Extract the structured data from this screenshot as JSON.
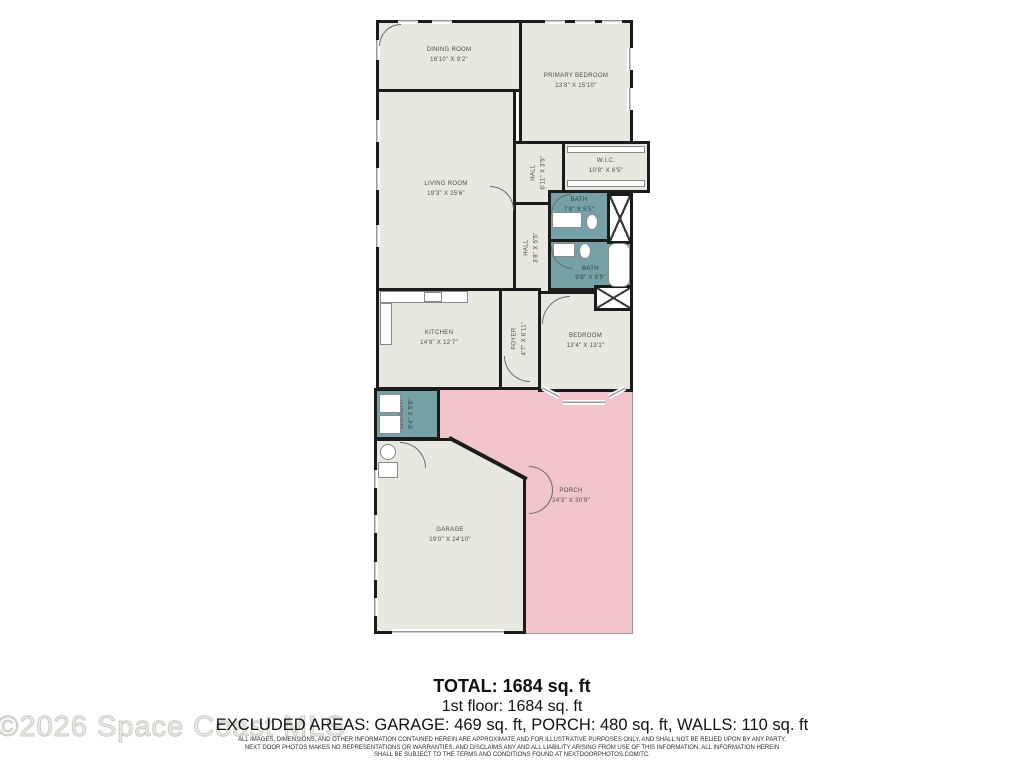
{
  "plan": {
    "rooms": {
      "dining": {
        "name": "DINING ROOM",
        "dims": "16'10\" X 9'2\""
      },
      "primary": {
        "name": "PRIMARY BEDROOM",
        "dims": "13'8\" X 15'10\""
      },
      "living": {
        "name": "LIVING ROOM",
        "dims": "19'3\" X 25'6\""
      },
      "wic": {
        "name": "W.I.C.",
        "dims": "10'8\" X 6'5\""
      },
      "hall1": {
        "name": "HALL",
        "dims": "6'11\" X 3'5\""
      },
      "hall2": {
        "name": "HALL",
        "dims": "3'8\" X 5'5\""
      },
      "bath1": {
        "name": "BATH",
        "dims": "7'8\" X 5'5\""
      },
      "bath2": {
        "name": "BATH",
        "dims": "9'8\" X 8'5\""
      },
      "kitchen": {
        "name": "KITCHEN",
        "dims": "14'9\" X 12'7\""
      },
      "foyer": {
        "name": "FOYER",
        "dims": "4'7\" X 6'11\""
      },
      "bedroom": {
        "name": "BEDROOM",
        "dims": "13'4\" X 13'1\""
      },
      "laundry": {
        "name": "LAUNDRY",
        "dims": "8'4\" X 5'5\""
      },
      "garage": {
        "name": "GARAGE",
        "dims": "19'0\" X 24'10\""
      },
      "porch": {
        "name": "PORCH",
        "dims": "24'3\" X 30'9\""
      }
    },
    "colors": {
      "wall": "#1b1b1b",
      "floor": "#e9e8e0",
      "wet_area": "#76a1a7",
      "excluded_area": "#f1c5c9"
    }
  },
  "summary": {
    "total": "TOTAL: 1684 sq. ft",
    "floor1": "1st floor: 1684 sq. ft",
    "excluded": "EXCLUDED AREAS: GARAGE: 469 sq. ft, PORCH: 480 sq. ft, WALLS: 110 sq. ft"
  },
  "disclaimer": {
    "line1": "ALL IMAGES, DIMENSIONS, AND OTHER INFORMATION CONTAINED HEREIN ARE APPROXIMATE AND FOR ILLUSTRATIVE PURPOSES ONLY, AND SHALL NOT BE RELIED UPON BY ANY PARTY.",
    "line2": "NEXT DOOR PHOTOS MAKES NO REPRESENTATIONS OR WARRANTIES, AND DISCLAIMS ANY AND ALL LIABILITY ARISING FROM USE OF THIS INFORMATION. ALL INFORMATION HEREIN",
    "line3": "SHALL BE SUBJECT TO THE TERMS AND CONDITIONS FOUND AT NEXTDOORPHOTOS.COM/TC."
  },
  "watermark": "©2026 Space Coast MLS"
}
